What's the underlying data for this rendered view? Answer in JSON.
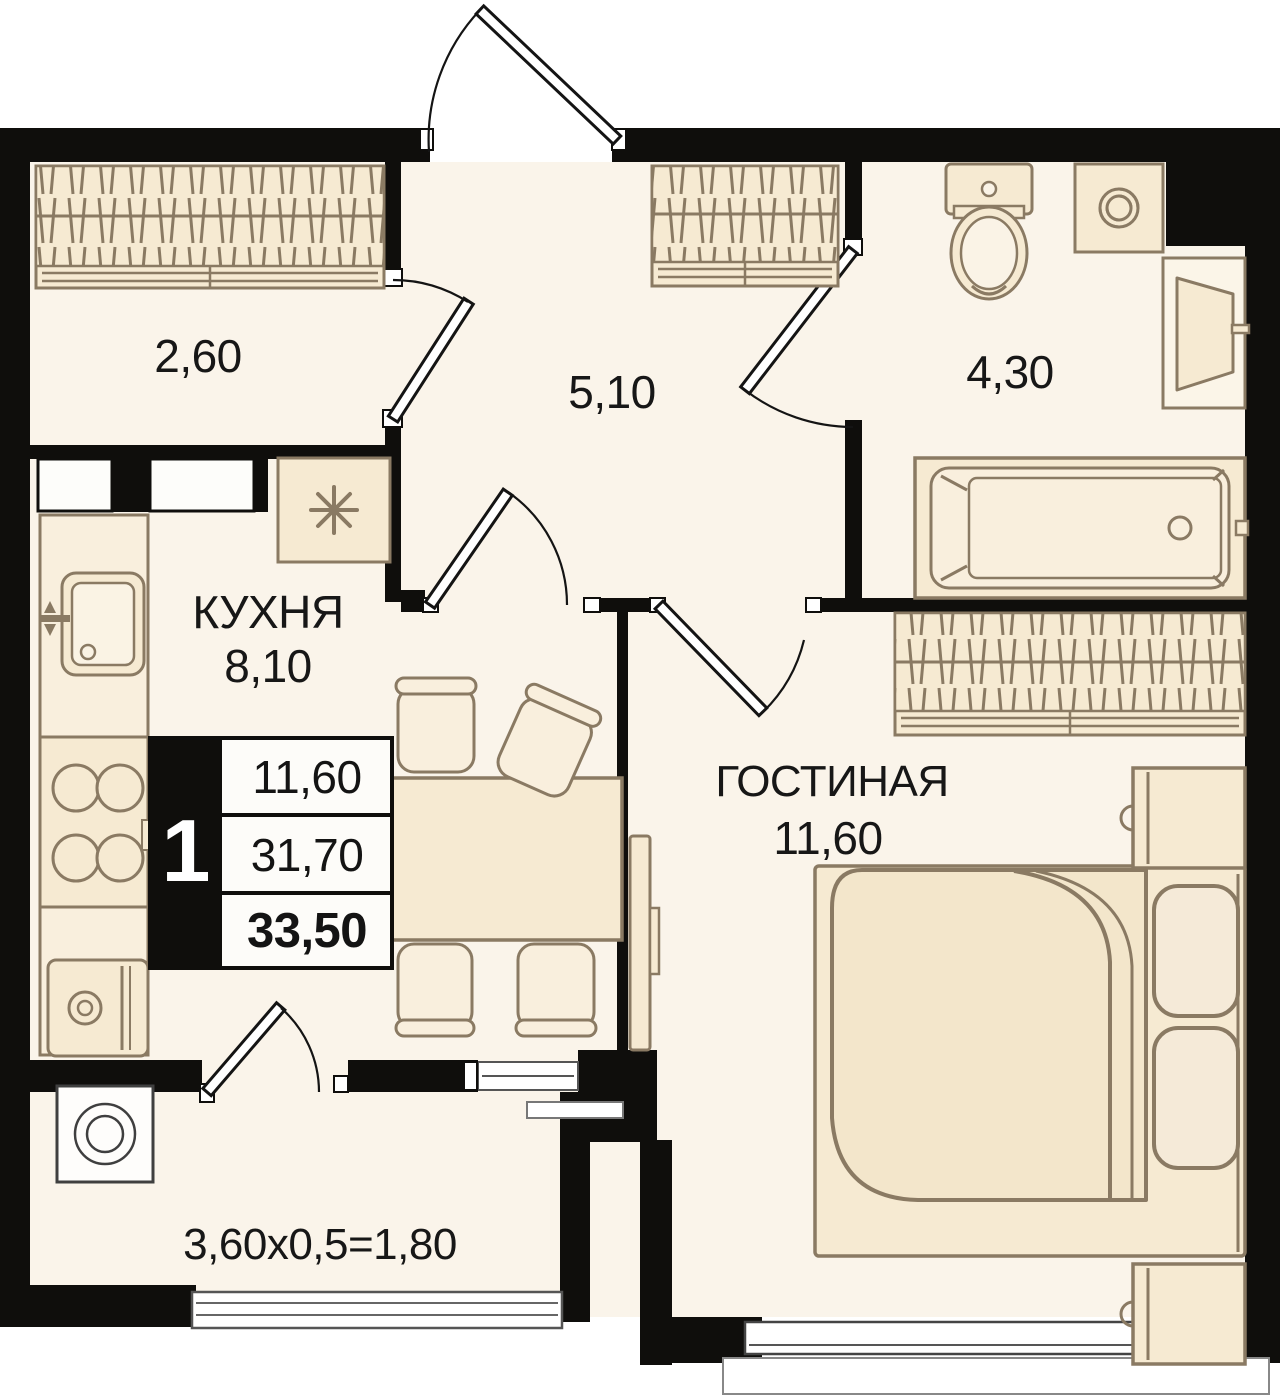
{
  "floorplan": {
    "rooms": {
      "loggia_top": {
        "area": "2,60"
      },
      "hallway": {
        "area": "5,10"
      },
      "bathroom": {
        "area": "4,30"
      },
      "kitchen": {
        "name": "КУХНЯ",
        "area": "8,10"
      },
      "living_room": {
        "name": "ГОСТИНАЯ",
        "area": "11,60"
      },
      "balcony": {
        "area_calc": "3,60x0,5=1,80"
      }
    },
    "info_box": {
      "rooms_count": "1",
      "living_area": "11,60",
      "area_without_summer": "31,70",
      "total_area": "33,50"
    },
    "colors": {
      "wall": "#0f0e0c",
      "room_fill": "#faf4ea",
      "furniture_fill": "#f6ead2",
      "furniture_fill_light": "#f9efdd",
      "furniture_stroke": "#8a7a63",
      "text": "#171717"
    }
  }
}
